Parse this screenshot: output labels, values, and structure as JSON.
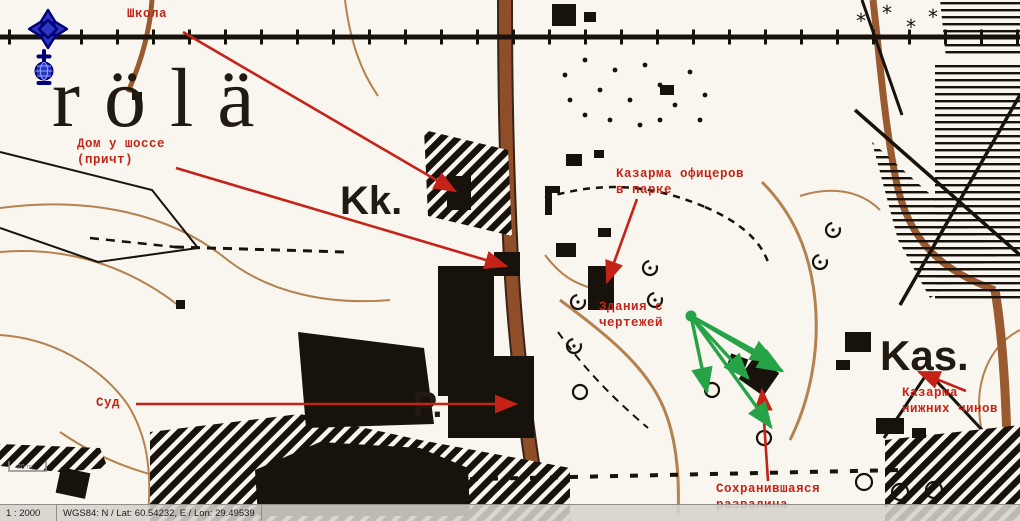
{
  "statusbar": {
    "scale": "1 : 2000",
    "coords": "WGS84: N / Lat: 60.54232, E / Lon: 29.49539"
  },
  "navigation": {
    "zoom_in_label": "+",
    "zoom_out_label": "−",
    "pan_icon": "pan-cross",
    "globe_icon": "globe"
  },
  "map": {
    "place_name": "rölä",
    "label_kk": "Kk.",
    "label_kas": "Kas.",
    "label_p": "P.",
    "scalebar_label": "20 m"
  },
  "annotations": {
    "school": {
      "text": "Школа"
    },
    "house_by_highway": {
      "text": "Дом у шоссе\n(причт)"
    },
    "officers_barracks": {
      "text": "Казарма офицеров\nв парке"
    },
    "buildings_from_drawings": {
      "text": "Здания с\nчертежей"
    },
    "court": {
      "text": "Суд"
    },
    "lower_ranks_barracks": {
      "text": "Казарма\nнижних чинов"
    },
    "preserved_ruin": {
      "text": "Сохранившаяся\nразвалина"
    }
  },
  "colors": {
    "annotation_red": "#c52318",
    "annotation_green": "#27a347",
    "road_brown": "#8f4d28",
    "contour_brown": "#b5814e",
    "nav_blue": "#2b35c0",
    "nav_navy": "#000079",
    "map_ink": "#1b140c"
  }
}
